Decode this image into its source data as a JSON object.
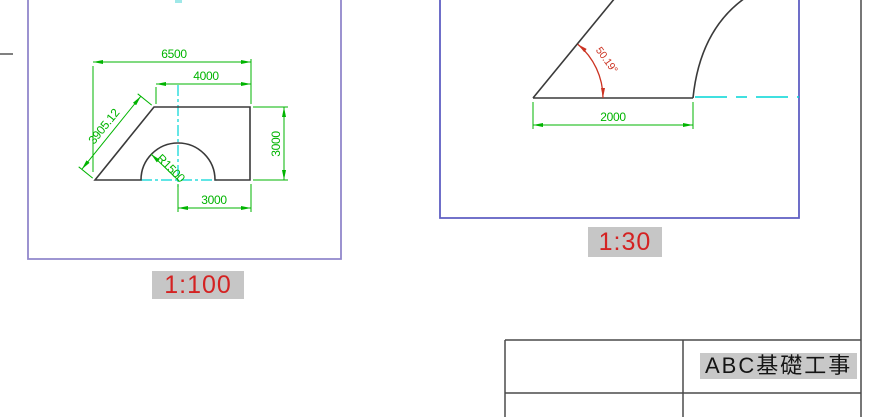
{
  "left_view": {
    "scale_label": "1:100",
    "dims": {
      "total_width": "6500",
      "top_width": "4000",
      "right_height": "3000",
      "bottom_width": "3000",
      "radius": "R1500",
      "diagonal": "3905.12"
    }
  },
  "right_view": {
    "scale_label": "1:30",
    "dims": {
      "bottom_width": "2000",
      "angle": "50.19°"
    }
  },
  "title_block": {
    "project_title": "ABC基礎工事"
  },
  "colors": {
    "dimension_green": "#00b400",
    "centerline_cyan": "#00d5d5",
    "angle_red": "#cc3322",
    "scale_label_red": "#d42222",
    "highlight_gray": "#c6c6c6",
    "viewport_left_border": "#9187cb",
    "viewport_right_border": "#5f5fc3",
    "drawing_line_black": "#3a3a3a"
  }
}
